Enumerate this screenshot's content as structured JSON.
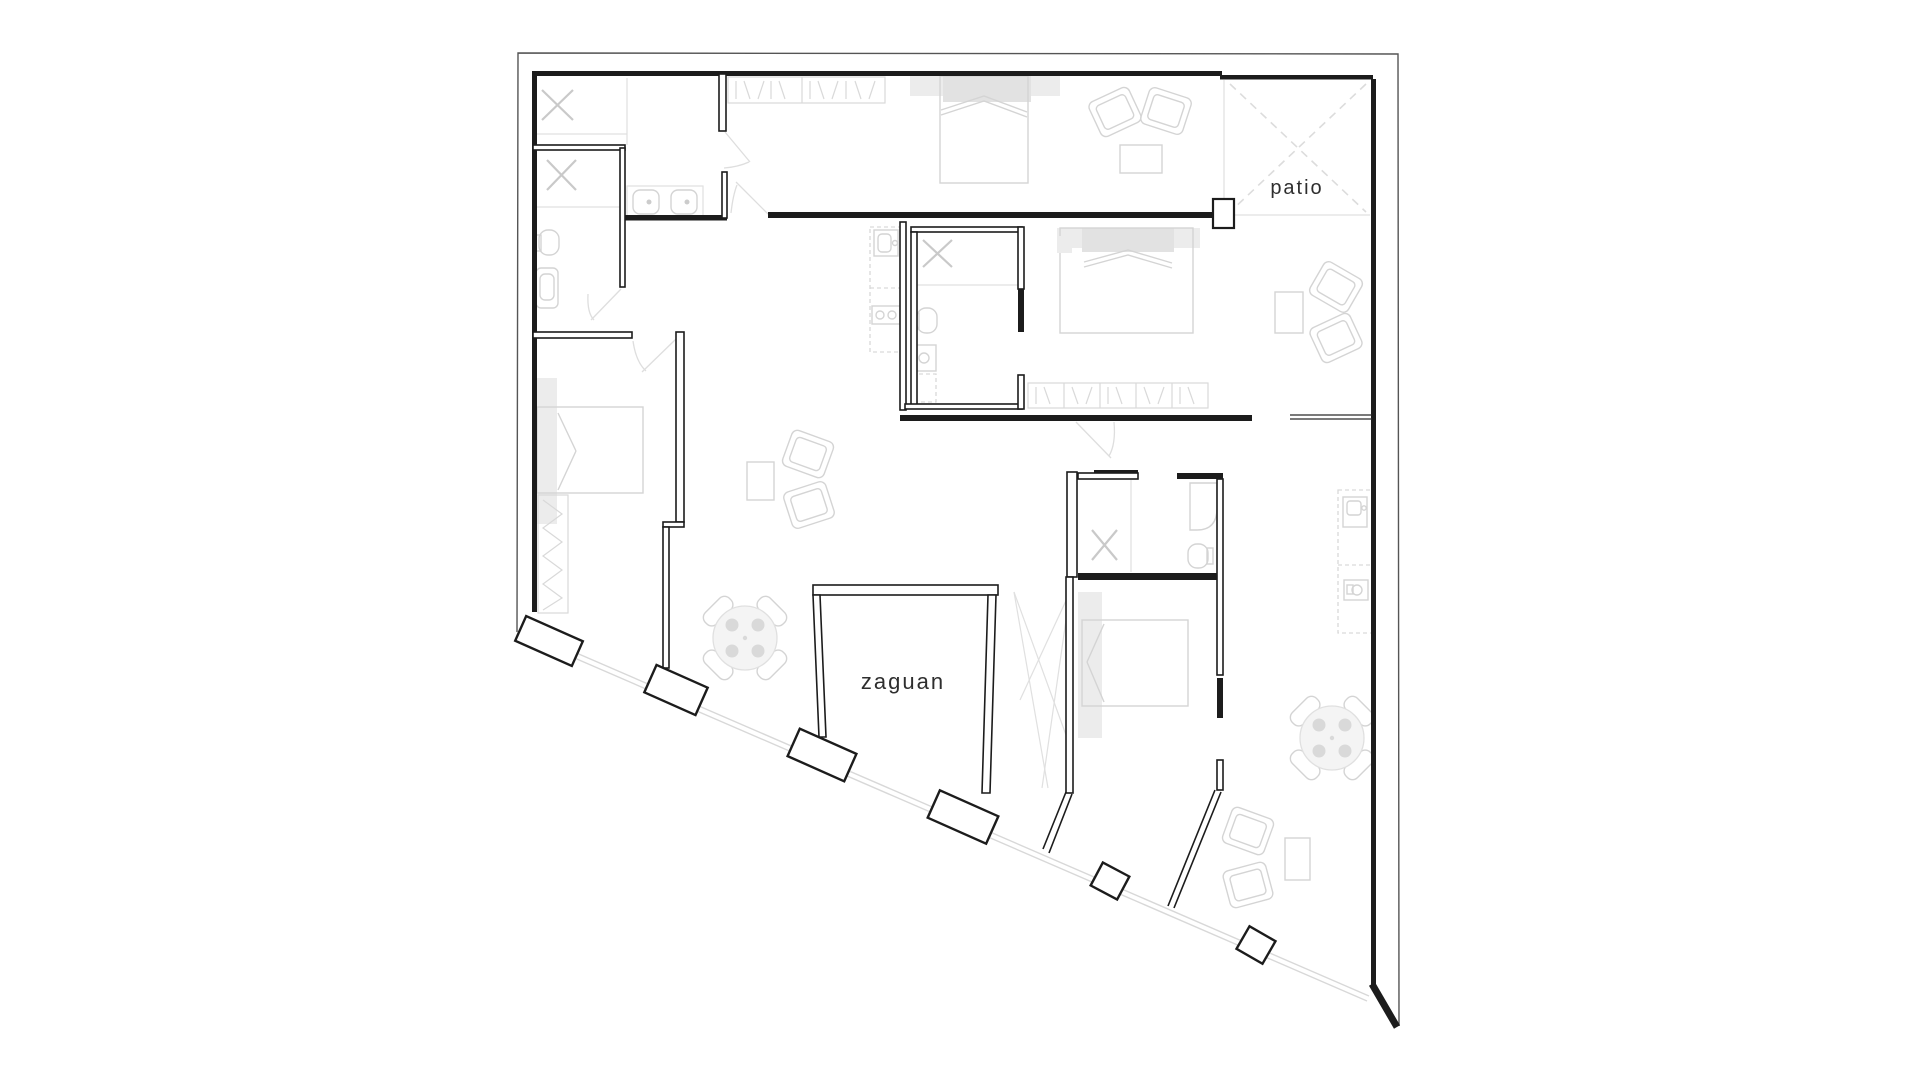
{
  "document": {
    "type": "architectural-floor-plan",
    "background": "#ffffff"
  },
  "labels": {
    "patio": "patio",
    "zaguan": "zaguan"
  },
  "colors": {
    "wall": "#1c1c1c",
    "outer_boundary": "#555555",
    "furniture": "#d4d4d4",
    "furniture_fill": "#ececec",
    "light_detail": "#e0e0e0",
    "patio_dash": "#d8d8d8",
    "facade_line": "#d8d8d8",
    "label_text": "#2e2e2e"
  },
  "features": {
    "labeled_rooms": [
      "patio",
      "zaguan"
    ],
    "beds": 4,
    "round_tables_with_chairs": 2,
    "armchair_groups": 4,
    "entry_pillars": 4,
    "small_columns": 2,
    "wardrobe_bands": 2,
    "kitchen_counters": 2,
    "bathroom_x_fixtures": 4
  }
}
